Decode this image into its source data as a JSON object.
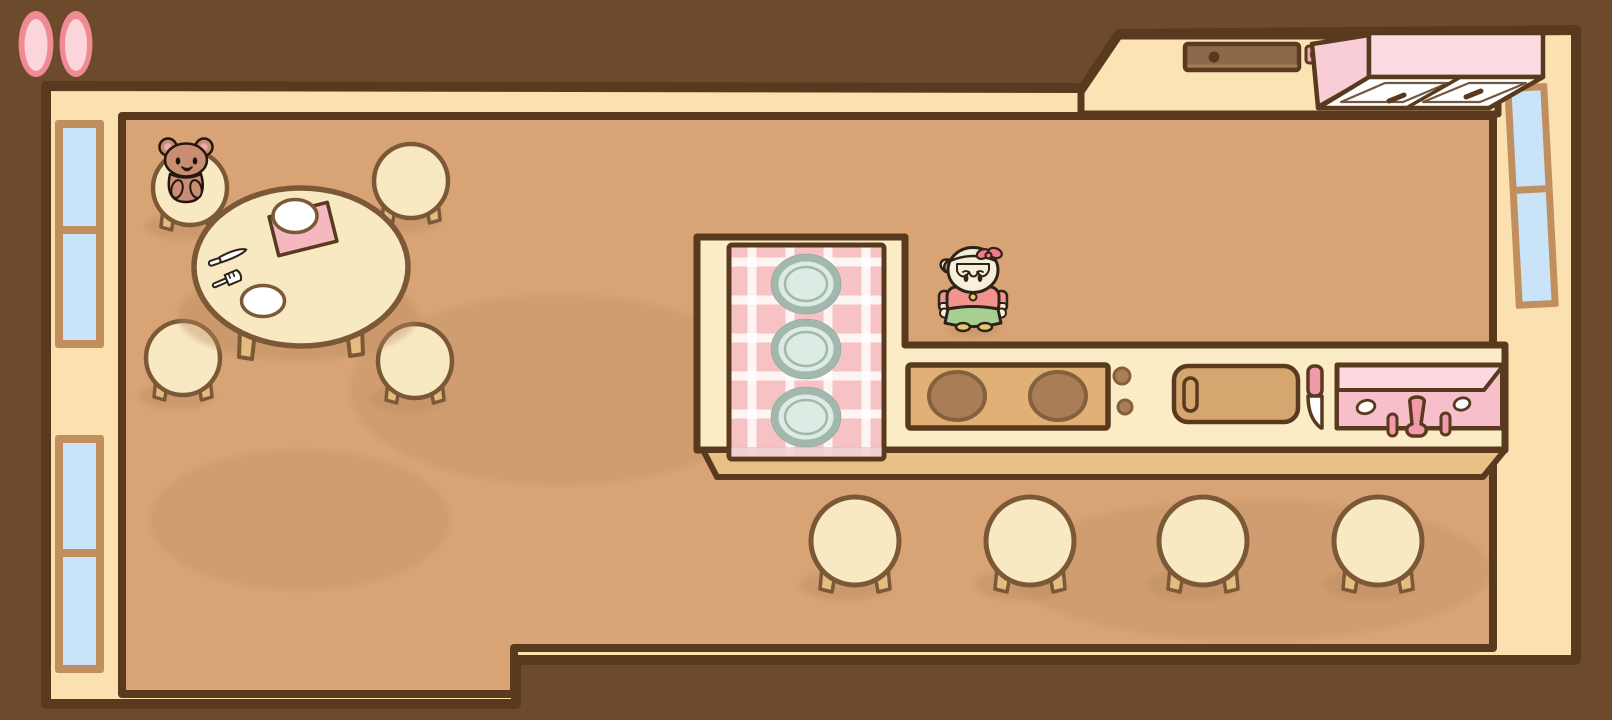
{
  "meta": {
    "app": "cozy-kitchen-game",
    "scene": "dining-room-and-kitchen",
    "viewport_width": 1612,
    "viewport_height": 720
  },
  "hud": {
    "pill_buttons": [
      {
        "id": "pill-left",
        "shape": "vertical-oval",
        "color": "pink"
      },
      {
        "id": "pill-right",
        "shape": "vertical-oval",
        "color": "pink"
      }
    ]
  },
  "scene": {
    "objects": [
      "dining-table",
      "teddy-bear",
      "table-stools",
      "table-plates",
      "napkin",
      "knife",
      "fork",
      "kitchen-island",
      "gingham-mat",
      "mat-plates",
      "stove",
      "stove-knobs",
      "cutting-board",
      "paring-knife",
      "pink-sink",
      "island-stools",
      "back-counter",
      "back-sink-basin",
      "sponge",
      "wall-cabinet",
      "left-windows",
      "right-window",
      "player-character"
    ],
    "counts": {
      "table_stools": 4,
      "island_stools": 4,
      "mat_plates": 3,
      "table_plates": 2,
      "stove_burners": 2,
      "stove_knobs": 2,
      "left_windows": 2,
      "right_windows": 1,
      "cabinet_doors": 2
    },
    "character": {
      "hair": "pale-blonde",
      "accessory": "pink-bow-headband",
      "top": "salmon-pink-sweater",
      "bottom": "green-skirt",
      "shoes": "yellow"
    }
  },
  "colors": {
    "bg": "#6e4a2c",
    "line": "#593a1e",
    "wall": "#fbe1af",
    "floor": "#d8a475",
    "floor_shade": "#b9895e",
    "counter": "#fcecc6",
    "counter_front": "#e9c185",
    "nook": "#fbe3b3",
    "stool": "#f9e9c3",
    "stool_line": "#7b5836",
    "leg": "#e5bc80",
    "stove": "#e0b077",
    "burner": "#a97e57",
    "burner_line": "#84603c",
    "board": "#d6a671",
    "mat": "#f6c2c3",
    "stripe": "#ffffff",
    "plate_fill": "#dcebe4",
    "plate_rim": "#a3b8ad",
    "sink_top": "#fcd9e1",
    "sink_body": "#f6bfca",
    "sink_accent": "#f09aab",
    "window_frame": "#c18f5e",
    "glass": "#c9e3f8",
    "cab_front": "#fbdce2",
    "cab_side": "#f9cdd7",
    "door": "#ffffff",
    "basin": "#8d6849",
    "drain": "#59391d",
    "sponge": "#f2a4b2",
    "pill_outer": "#ef8b95",
    "pill_inner": "#fbd5d9",
    "bear": "#c98d72",
    "bear_line": "#241711",
    "ear_pink": "#f0a9ac",
    "hair": "#f5eed8",
    "skin": "#fceddc",
    "shirt": "#f2948d",
    "skirt": "#a8cf92",
    "shoes": "#e9c76f",
    "bow": "#f4798b",
    "char_line": "#2e2318",
    "cuff": "#fbe9d6",
    "pendant": "#ecc666"
  }
}
